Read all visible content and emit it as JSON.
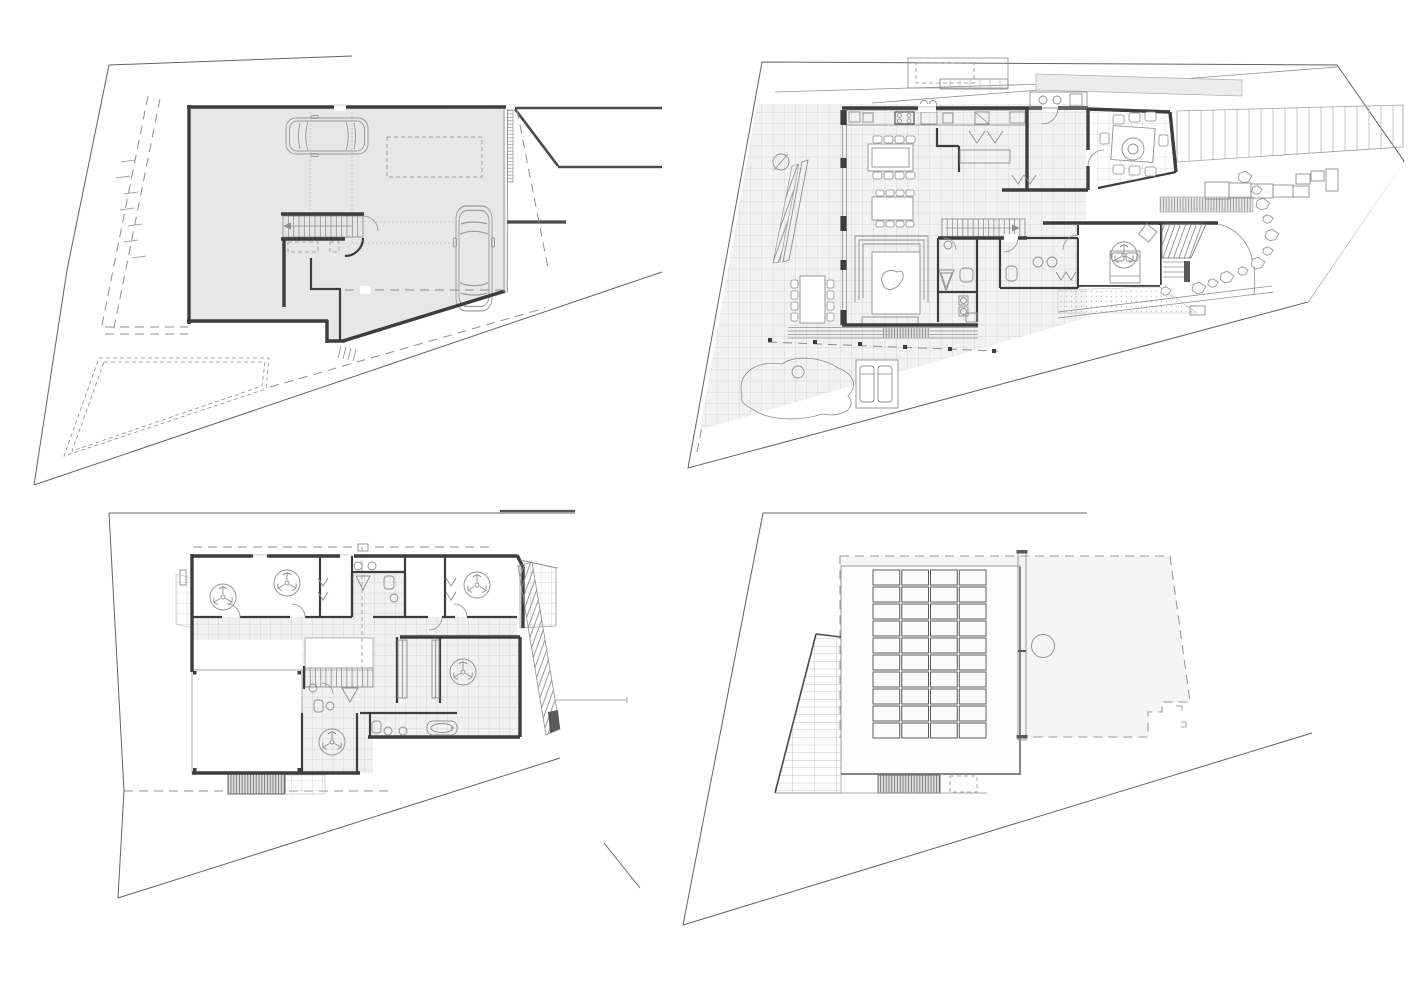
{
  "canvas": {
    "width": 1414,
    "height": 1000,
    "background": "#ffffff"
  },
  "palette": {
    "wall": "#3d3d3d",
    "line_dark": "#636363",
    "line_mid": "#8f8f8f",
    "line_light": "#b9b9b9",
    "tile_line": "#cdcdcd",
    "garage_fill": "#e7e7e7",
    "tile_fill": "#f2f2f2",
    "roof_fill": "#f5f5f5",
    "slab_fill": "#fdfdfd",
    "hatch_dark": "#6e6e6e"
  },
  "plans": [
    {
      "id": "basement-garage-plan",
      "quadrant": "top-left",
      "cars": 2,
      "stair": {
        "x": 283,
        "y": 216,
        "w": 80,
        "h": 21,
        "treads": 15
      },
      "bay_ticks": [
        [
          128,
          162
        ],
        [
          123,
          178
        ],
        [
          131,
          194
        ],
        [
          127,
          210
        ],
        [
          135,
          226
        ],
        [
          131,
          242
        ],
        [
          139,
          258
        ]
      ]
    },
    {
      "id": "ground-floor-plan",
      "quadrant": "top-right",
      "stair": {
        "x": 942,
        "y": 219,
        "w": 83,
        "h": 18,
        "treads": 16
      },
      "fans": [
        [
          1124,
          255
        ]
      ],
      "rocks": [
        [
          1245,
          177
        ],
        [
          1257,
          190
        ],
        [
          1263,
          204
        ],
        [
          1268,
          219
        ],
        [
          1272,
          235
        ],
        [
          1268,
          251
        ],
        [
          1258,
          263
        ],
        [
          1243,
          271
        ],
        [
          1227,
          277
        ],
        [
          1213,
          283
        ],
        [
          1199,
          288
        ],
        [
          1166,
          291
        ]
      ],
      "fence_posts": [
        [
          770,
          340
        ],
        [
          815,
          342
        ],
        [
          860,
          344
        ],
        [
          905,
          347
        ],
        [
          950,
          349
        ],
        [
          994,
          351
        ]
      ],
      "dining_chairs": 8,
      "island_chairs": 8,
      "alfresco_chairs": 8,
      "outdoor_chairs": 8
    },
    {
      "id": "upper-floor-plan",
      "quadrant": "bottom-left",
      "stair": {
        "x": 305,
        "y": 668,
        "w": 68,
        "h": 19,
        "treads": 13
      },
      "fans": [
        [
          223,
          597
        ],
        [
          287,
          583
        ],
        [
          477,
          585
        ],
        [
          463,
          672
        ],
        [
          332,
          742
        ]
      ]
    },
    {
      "id": "roof-plan",
      "quadrant": "bottom-right",
      "solar_array": {
        "x": 872,
        "y": 569,
        "cols": 4,
        "rows": 10,
        "cell_w": 28.75,
        "cell_h": 17,
        "gap": 2
      },
      "skylight": {
        "cx": 1043,
        "cy": 646,
        "r": 11.5
      }
    }
  ]
}
